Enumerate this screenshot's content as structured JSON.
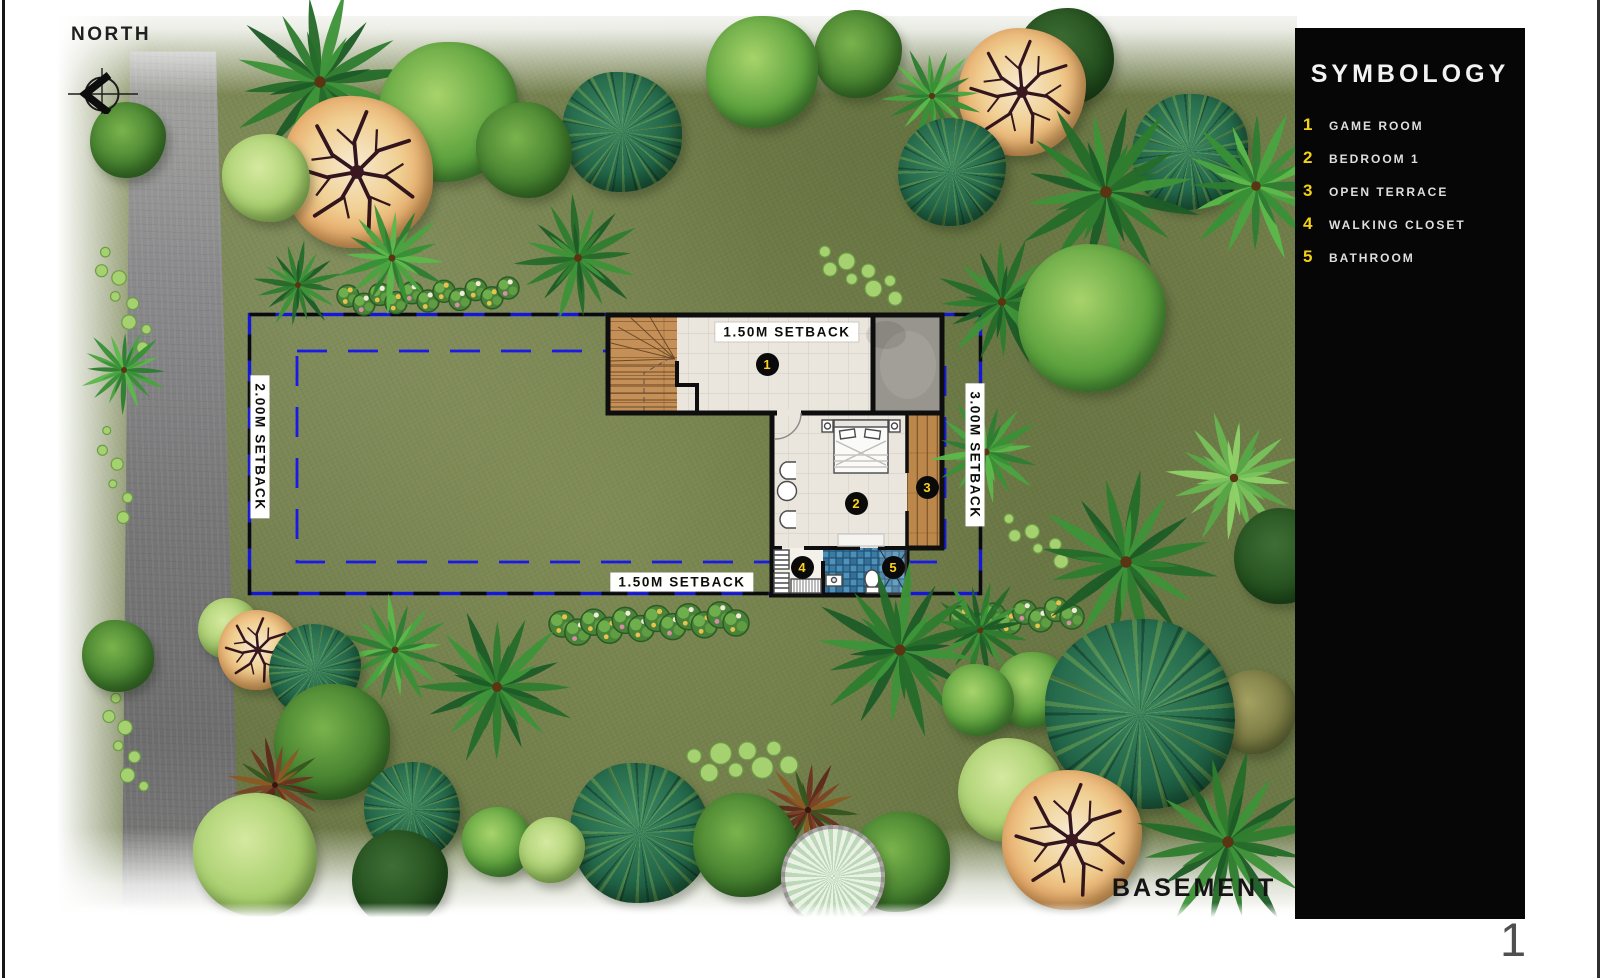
{
  "colors": {
    "boundary_blue": "#1517d6",
    "badge_yellow": "#ffd21f",
    "panel_bg": "#060606",
    "label_bg": "#ffffff"
  },
  "north": {
    "label": "NORTH"
  },
  "symbology": {
    "title": "SYMBOLOGY",
    "items": [
      {
        "num": "1",
        "label": "GAME ROOM"
      },
      {
        "num": "2",
        "label": "BEDROOM 1"
      },
      {
        "num": "3",
        "label": "OPEN TERRACE"
      },
      {
        "num": "4",
        "label": "WALKING CLOSET"
      },
      {
        "num": "5",
        "label": "BATHROOM"
      }
    ]
  },
  "plan": {
    "setback_top": "1.50M SETBACK",
    "setback_bottom": "1.50M SETBACK",
    "setback_left": "2.00M SETBACK",
    "setback_right": "3.00M SETBACK",
    "badges": [
      {
        "num": "1",
        "x": 767,
        "y": 364
      },
      {
        "num": "2",
        "x": 856,
        "y": 503
      },
      {
        "num": "3",
        "x": 927,
        "y": 487
      },
      {
        "num": "4",
        "x": 802,
        "y": 567
      },
      {
        "num": "5",
        "x": 893,
        "y": 567
      }
    ]
  },
  "footer": {
    "basement_label": "BASEMENT",
    "page_number": "1"
  },
  "landscape": {
    "trees": [
      {
        "t": "palm",
        "x": 320,
        "y": 82,
        "r": 95,
        "c": "g1"
      },
      {
        "t": "orange",
        "x": 357,
        "y": 172,
        "r": 76
      },
      {
        "t": "shrub",
        "x": 266,
        "y": 178,
        "r": 44
      },
      {
        "t": "round",
        "x": 448,
        "y": 112,
        "r": 70,
        "v": "bright"
      },
      {
        "t": "round",
        "x": 524,
        "y": 150,
        "r": 48,
        "v": "mid"
      },
      {
        "t": "mosaic",
        "x": 622,
        "y": 132,
        "r": 60
      },
      {
        "t": "palm",
        "x": 392,
        "y": 258,
        "r": 58,
        "c": "g2"
      },
      {
        "t": "palm",
        "x": 298,
        "y": 285,
        "r": 46,
        "c": "g1"
      },
      {
        "t": "palm",
        "x": 578,
        "y": 258,
        "r": 66,
        "c": "g1"
      },
      {
        "t": "round",
        "x": 762,
        "y": 72,
        "r": 56,
        "v": "bright"
      },
      {
        "t": "round",
        "x": 858,
        "y": 54,
        "r": 44,
        "v": "mid"
      },
      {
        "t": "palm",
        "x": 932,
        "y": 96,
        "r": 52,
        "c": "g2"
      },
      {
        "t": "orange",
        "x": 1022,
        "y": 92,
        "r": 64
      },
      {
        "t": "round",
        "x": 1066,
        "y": 56,
        "r": 48,
        "v": "dark"
      },
      {
        "t": "mosaic",
        "x": 952,
        "y": 172,
        "r": 54
      },
      {
        "t": "palm",
        "x": 1106,
        "y": 192,
        "r": 98,
        "c": "g1"
      },
      {
        "t": "mosaic",
        "x": 1190,
        "y": 152,
        "r": 58
      },
      {
        "t": "palm",
        "x": 1256,
        "y": 186,
        "r": 80,
        "c": "g2"
      },
      {
        "t": "palm",
        "x": 1002,
        "y": 302,
        "r": 68,
        "c": "g1"
      },
      {
        "t": "round",
        "x": 1092,
        "y": 318,
        "r": 74,
        "v": "bright"
      },
      {
        "t": "palm",
        "x": 986,
        "y": 452,
        "r": 58,
        "c": "g2"
      },
      {
        "t": "palm",
        "x": 1126,
        "y": 562,
        "r": 95,
        "c": "g1"
      },
      {
        "t": "palm",
        "x": 1234,
        "y": 478,
        "r": 70,
        "c": "g3"
      },
      {
        "t": "round",
        "x": 1282,
        "y": 556,
        "r": 48,
        "v": "dark"
      },
      {
        "t": "palm",
        "x": 980,
        "y": 630,
        "r": 55,
        "c": "g1"
      },
      {
        "t": "round",
        "x": 128,
        "y": 140,
        "r": 38,
        "v": "mid"
      },
      {
        "t": "palm",
        "x": 124,
        "y": 370,
        "r": 46,
        "c": "g2"
      },
      {
        "t": "round",
        "x": 118,
        "y": 656,
        "r": 36,
        "v": "mid"
      },
      {
        "t": "shrub",
        "x": 228,
        "y": 628,
        "r": 30
      },
      {
        "t": "orange",
        "x": 258,
        "y": 650,
        "r": 40
      },
      {
        "t": "mosaic",
        "x": 315,
        "y": 670,
        "r": 46
      },
      {
        "t": "round",
        "x": 332,
        "y": 742,
        "r": 58,
        "v": "mid"
      },
      {
        "t": "palm",
        "x": 275,
        "y": 785,
        "r": 50,
        "c": "red"
      },
      {
        "t": "shrub",
        "x": 255,
        "y": 855,
        "r": 62
      },
      {
        "t": "palm",
        "x": 395,
        "y": 650,
        "r": 58,
        "c": "g2"
      },
      {
        "t": "palm",
        "x": 497,
        "y": 687,
        "r": 82,
        "c": "g1"
      },
      {
        "t": "mosaic",
        "x": 412,
        "y": 810,
        "r": 48
      },
      {
        "t": "round",
        "x": 400,
        "y": 878,
        "r": 48,
        "v": "dark"
      },
      {
        "t": "round",
        "x": 497,
        "y": 842,
        "r": 35,
        "v": "bright"
      },
      {
        "t": "shrub",
        "x": 552,
        "y": 850,
        "r": 33
      },
      {
        "t": "mosaic",
        "x": 640,
        "y": 833,
        "r": 70
      },
      {
        "t": "round",
        "x": 745,
        "y": 845,
        "r": 52,
        "v": "mid"
      },
      {
        "t": "palm",
        "x": 808,
        "y": 810,
        "r": 52,
        "c": "red"
      },
      {
        "t": "fan",
        "x": 833,
        "y": 877,
        "r": 52
      },
      {
        "t": "round",
        "x": 900,
        "y": 862,
        "r": 50,
        "v": "mid"
      },
      {
        "t": "palm",
        "x": 900,
        "y": 650,
        "r": 92,
        "c": "g1"
      },
      {
        "t": "round",
        "x": 978,
        "y": 700,
        "r": 36,
        "v": "bright"
      },
      {
        "t": "round",
        "x": 1032,
        "y": 690,
        "r": 38,
        "v": "bright"
      },
      {
        "t": "mosaic",
        "x": 1140,
        "y": 714,
        "r": 95
      },
      {
        "t": "shrub",
        "x": 1010,
        "y": 790,
        "r": 52
      },
      {
        "t": "orange",
        "x": 1072,
        "y": 840,
        "r": 70
      },
      {
        "t": "round",
        "x": 1255,
        "y": 712,
        "r": 42,
        "v": "olive"
      },
      {
        "t": "palm",
        "x": 1228,
        "y": 842,
        "r": 95,
        "c": "g1"
      }
    ],
    "garlands": [
      {
        "x1": 348,
        "y1": 300,
        "x2": 508,
        "y2": 292,
        "n": 11,
        "s": 11
      },
      {
        "x1": 562,
        "y1": 628,
        "x2": 736,
        "y2": 618,
        "n": 12,
        "s": 13
      },
      {
        "x1": 962,
        "y1": 622,
        "x2": 1072,
        "y2": 612,
        "n": 8,
        "s": 12
      }
    ],
    "dotpaths": [
      {
        "x1": 100,
        "y1": 255,
        "x2": 148,
        "y2": 345,
        "n": 8,
        "r": 6
      },
      {
        "x1": 822,
        "y1": 258,
        "x2": 898,
        "y2": 292,
        "n": 8,
        "r": 7
      },
      {
        "x1": 1006,
        "y1": 524,
        "x2": 1064,
        "y2": 556,
        "n": 6,
        "r": 6
      },
      {
        "x1": 102,
        "y1": 432,
        "x2": 128,
        "y2": 516,
        "n": 6,
        "r": 5
      },
      {
        "x1": 110,
        "y1": 700,
        "x2": 138,
        "y2": 788,
        "n": 7,
        "r": 6
      },
      {
        "x1": 695,
        "y1": 765,
        "x2": 788,
        "y2": 756,
        "n": 8,
        "r": 9
      }
    ]
  }
}
